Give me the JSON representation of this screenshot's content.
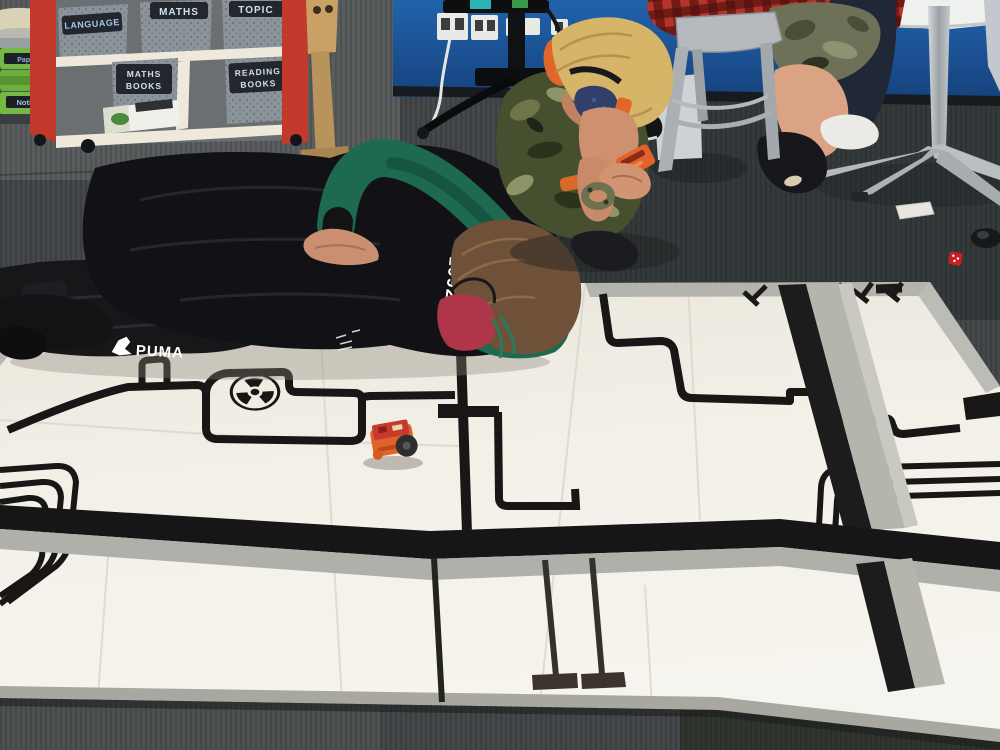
{
  "scene": {
    "title": "Classroom robotics lesson — two boys test an orange Edison robot on a white floor mat marked with black line-following tracks"
  },
  "shelf_unit": {
    "bins_top": [
      {
        "label": "LANGUAGE"
      },
      {
        "label": "MATHS"
      },
      {
        "label": "TOPIC"
      }
    ],
    "bins_bottom": [
      {
        "label_line1": "MATHS",
        "label_line2": "BOOKS"
      },
      {
        "label_line1": "READING",
        "label_line2": "BOOKS"
      }
    ],
    "frame_red": "#c0392b",
    "bin_grey": "#8b939b",
    "label_board": "#23272c"
  },
  "tray_trolley": {
    "trays": [
      {
        "label": "Paper"
      },
      {
        "label": ""
      },
      {
        "label": "Notices"
      }
    ],
    "tray_green": "#76b844"
  },
  "clothing": {
    "lying_boy_hoodie_year": "1992",
    "lying_boy_pants_brand": "PUMA"
  },
  "mat": {
    "surface_color": "#f3f0e8",
    "line_color": "#181715",
    "tape_silver": "#b4b4ac",
    "features": [
      "radiation-hazard-symbol",
      "line-follow-tracks",
      "direction-arrows",
      "thick-black-band",
      "silver-tape-strips"
    ]
  },
  "robot": {
    "name": "edison-robot",
    "body_orange": "#e2622b",
    "pcb_red": "#c43a2c"
  },
  "colors": {
    "carpet": "#44484a",
    "wall_blue": "#1d5a9e",
    "hoodie_green": "#1e6a50",
    "mask_red": "#ae3648",
    "mask_navy": "#31406b",
    "plaid_red": "#b5342a",
    "blond_hair": "#d6b468",
    "brown_hair": "#6e5138"
  }
}
